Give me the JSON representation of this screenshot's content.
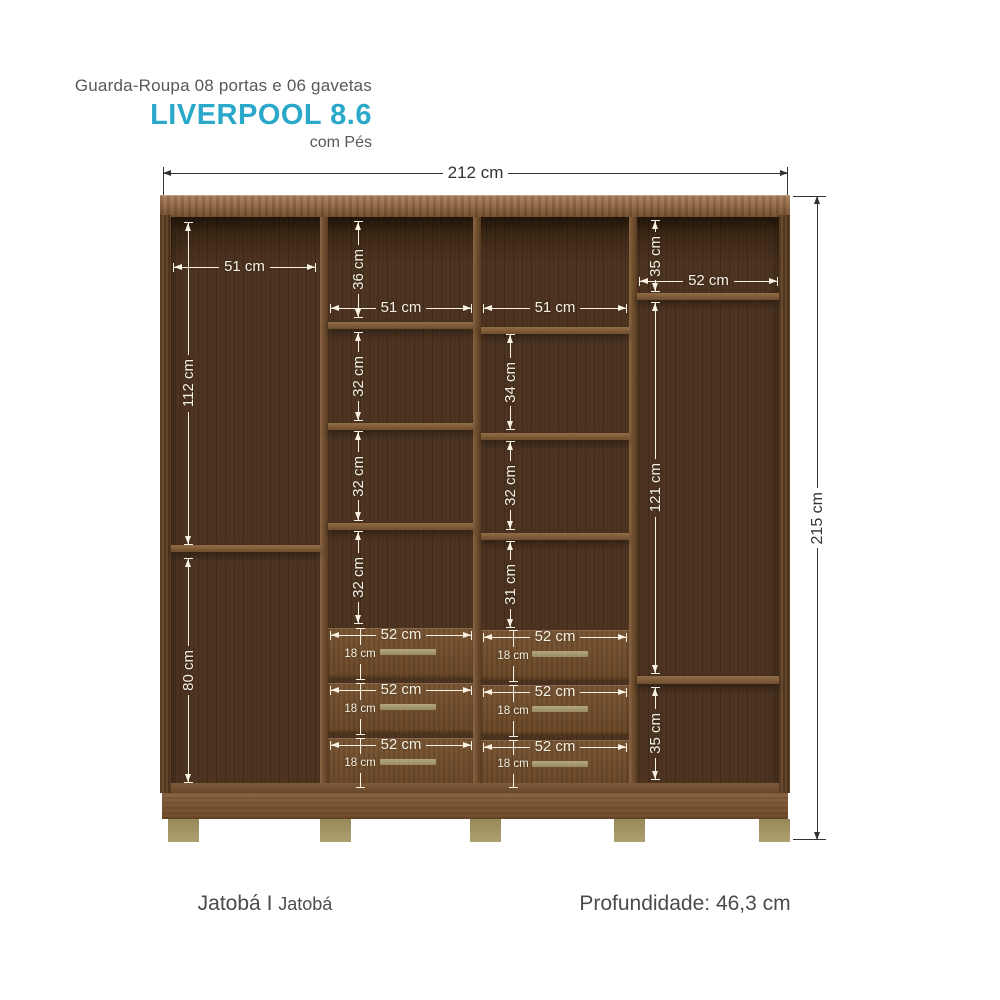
{
  "header": {
    "subtitle": "Guarda-Roupa 08 portas e 06 gavetas",
    "title": "LIVERPOOL 8.6",
    "variant": "com Pés"
  },
  "dims": {
    "overall_width": "212 cm",
    "overall_height": "215 cm",
    "col_left": {
      "width": "51 cm",
      "upper_height": "112 cm",
      "lower_height": "80 cm"
    },
    "col_mid_left": {
      "top_height": "36 cm",
      "width": "51 cm",
      "shelf1": "32 cm",
      "shelf2": "32 cm",
      "shelf3": "32 cm"
    },
    "col_mid_right": {
      "width": "51 cm",
      "shelf1": "34 cm",
      "shelf2": "32 cm",
      "shelf3": "31 cm"
    },
    "col_right": {
      "top_height": "35 cm",
      "width": "52 cm",
      "middle_height": "121 cm",
      "bottom_height": "35 cm"
    },
    "drawer": {
      "width": "52 cm",
      "height": "18 cm"
    }
  },
  "footer": {
    "finish_primary": "Jatobá",
    "finish_separator": "I",
    "finish_secondary": "Jatobá",
    "depth": "Profundidade: 46,3 cm"
  },
  "colors": {
    "accent": "#29a8c9",
    "text_gray": "#57585b",
    "dim_dark": "#323234",
    "dim_light": "#f7f2e2"
  }
}
